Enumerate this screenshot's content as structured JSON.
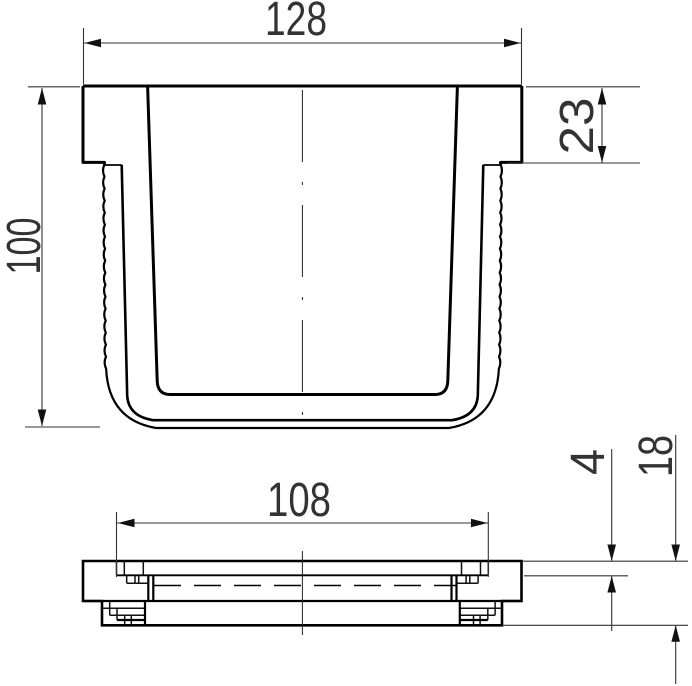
{
  "drawing": {
    "background": "#ffffff",
    "line_color": "#000000",
    "dim_color": "#333333",
    "views": {
      "front": {
        "title": "container-cross-section-front-view",
        "dimensions": {
          "top_width": "128",
          "rim_height": "23",
          "total_height": "100"
        }
      },
      "lid": {
        "title": "lid-side-view",
        "dimensions": {
          "inner_width": "108",
          "plate_thickness": "4",
          "total_height": "18"
        }
      }
    }
  }
}
